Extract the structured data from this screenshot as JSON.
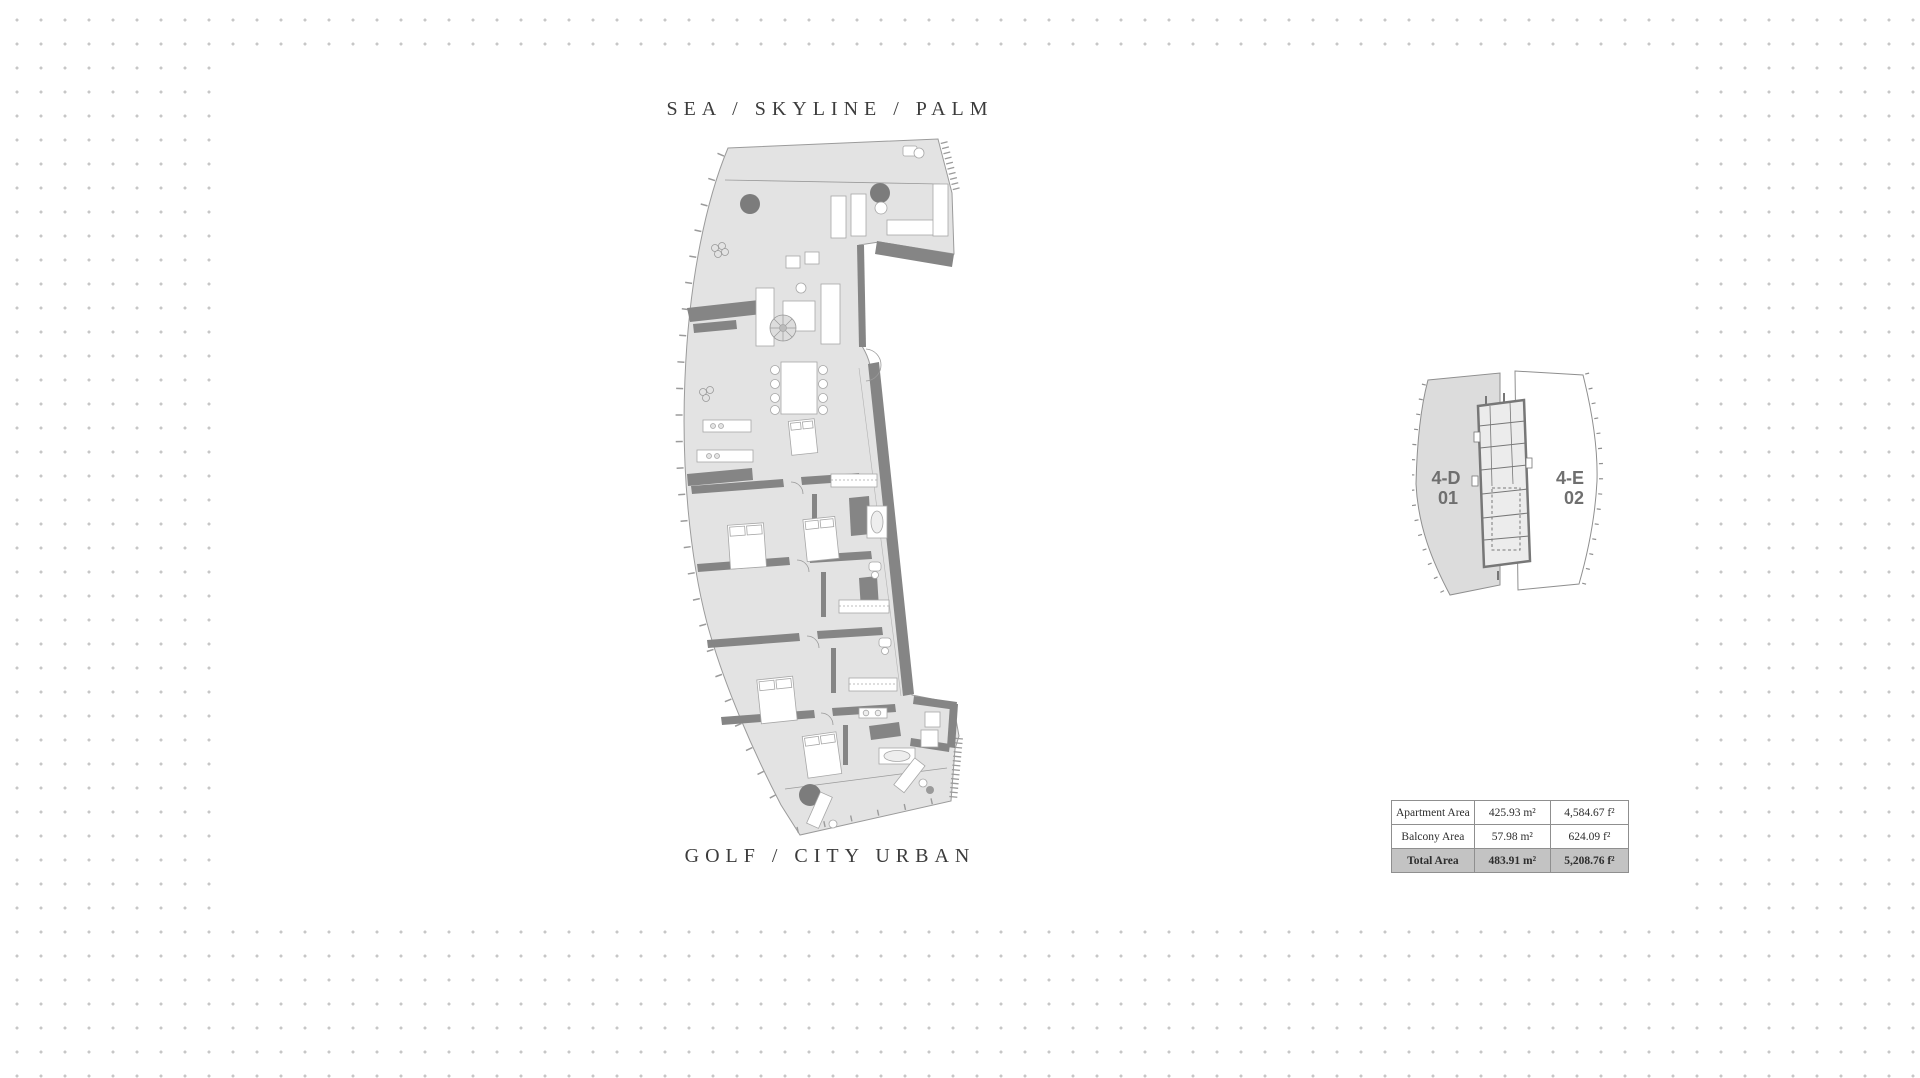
{
  "document": {
    "orientation_top": "SEA / SKYLINE / PALM",
    "orientation_bottom": "GOLF / CITY URBAN"
  },
  "key_plan": {
    "left_unit": {
      "code": "4-D",
      "number": "01"
    },
    "right_unit": {
      "code": "4-E",
      "number": "02"
    }
  },
  "area_table": {
    "rows": [
      {
        "label": "Apartment Area",
        "metric": "425.93 m²",
        "imperial": "4,584.67 f²"
      },
      {
        "label": "Balcony Area",
        "metric": "57.98 m²",
        "imperial": "624.09 f²"
      },
      {
        "label": "Total Area",
        "metric": "483.91 m²",
        "imperial": "5,208.76 f²"
      }
    ]
  },
  "colors": {
    "dot_grid": "#c7c7c7",
    "floor_fill": "#e3e3e3",
    "wall_dark": "#858585",
    "outline": "#9b9b9b",
    "table_highlight_row": "#c3c3c3",
    "title_text": "#3c3c3c",
    "unit_label_text": "#6f6f6f"
  }
}
